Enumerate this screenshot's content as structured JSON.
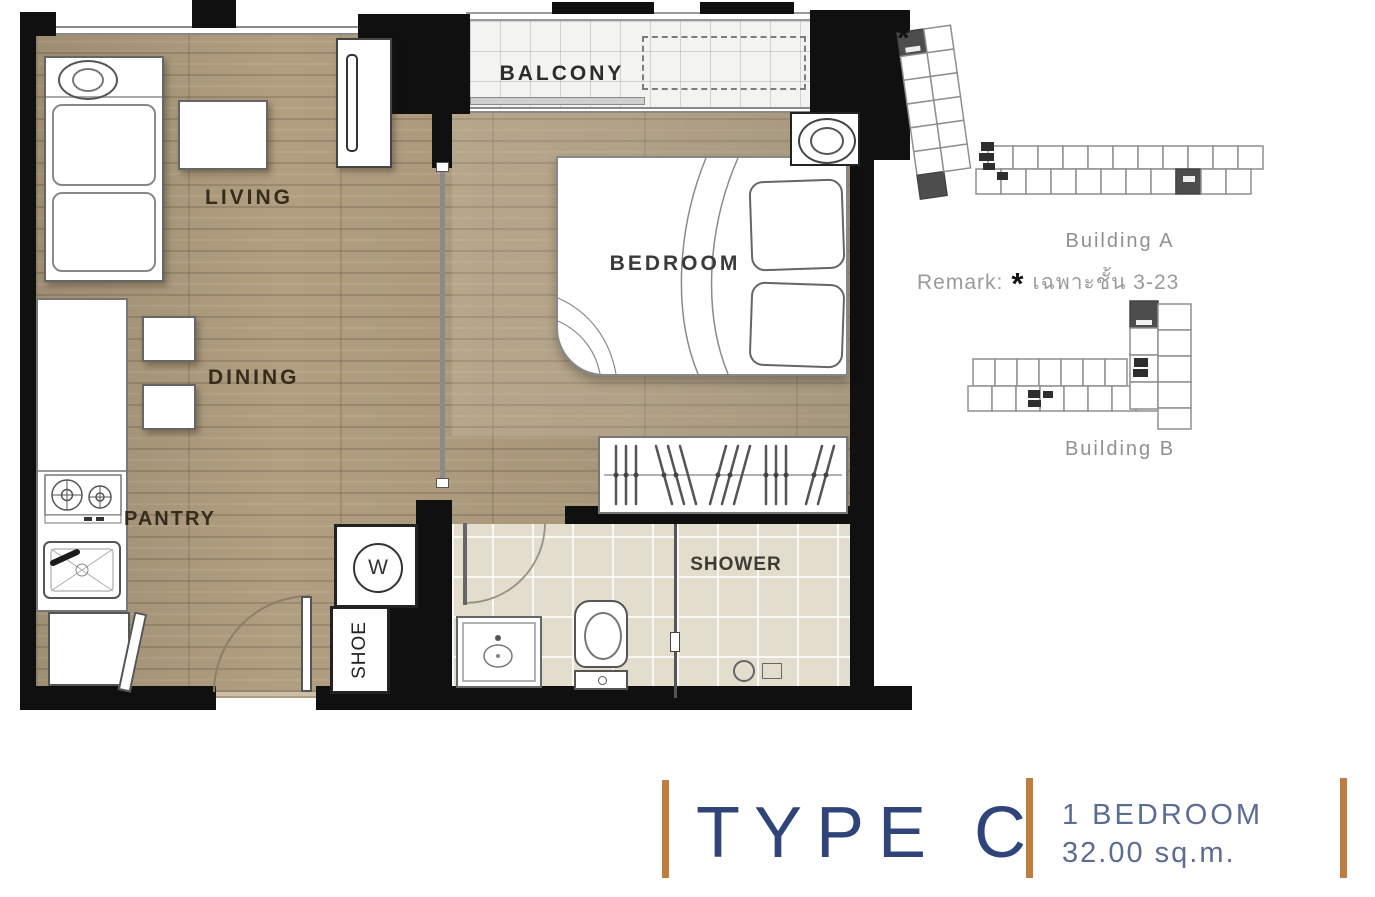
{
  "plan": {
    "rooms": {
      "living": "LIVING",
      "dining": "DINING",
      "pantry": "PANTRY",
      "balcony": "BALCONY",
      "bedroom": "BEDROOM",
      "shower": "SHOWER",
      "shoe_cabinet": "SHOE",
      "washer": "W"
    }
  },
  "key_plans": {
    "building_a_label": "Building A",
    "building_b_label": "Building B",
    "unit_marker": "*",
    "remark": {
      "prefix": "Remark:",
      "asterisk": "*",
      "text": "เฉพาะชั้น 3-23"
    }
  },
  "title_block": {
    "type_label": "TYPE C",
    "bedroom_label": "1 BEDROOM",
    "area_label": "32.00 sq.m."
  },
  "colors": {
    "accent_orange": "#bf7e3e",
    "title_navy": "#2f4579",
    "subtitle_blue": "#5b6d95",
    "wall_black": "#101010",
    "wood_floor": "#b19e80",
    "bath_tile": "#e2ddcc",
    "label_brown": "#2b2314",
    "key_plan_gray": "#909090",
    "marked_unit_gray": "#4d4d4d"
  }
}
